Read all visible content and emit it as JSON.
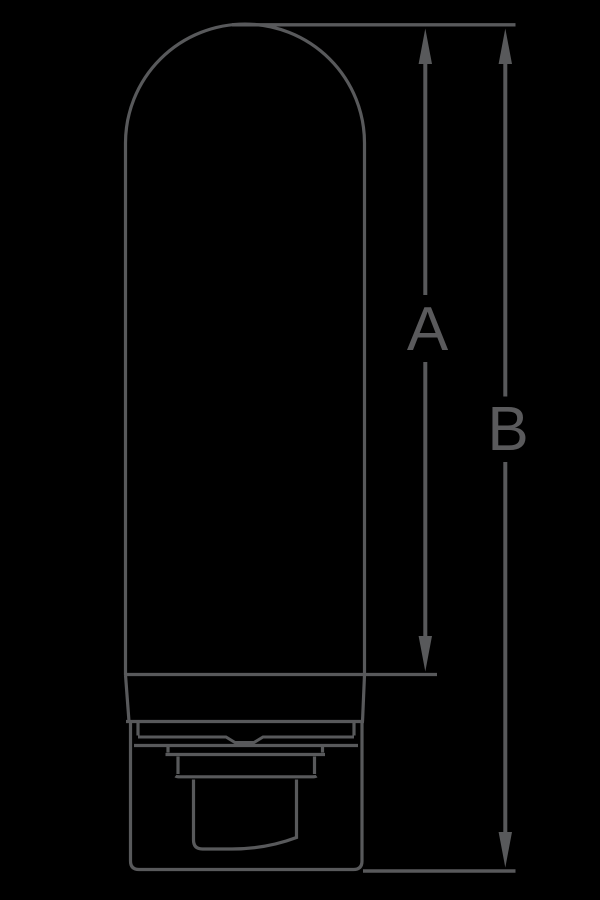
{
  "window": {
    "width_px": 600,
    "height_px": 900,
    "background_color": "#000000"
  },
  "drawing": {
    "line_color": "#58595b",
    "label_color": "#5a5a5c",
    "dimension_labels": {
      "a": "A",
      "b": "B"
    }
  }
}
